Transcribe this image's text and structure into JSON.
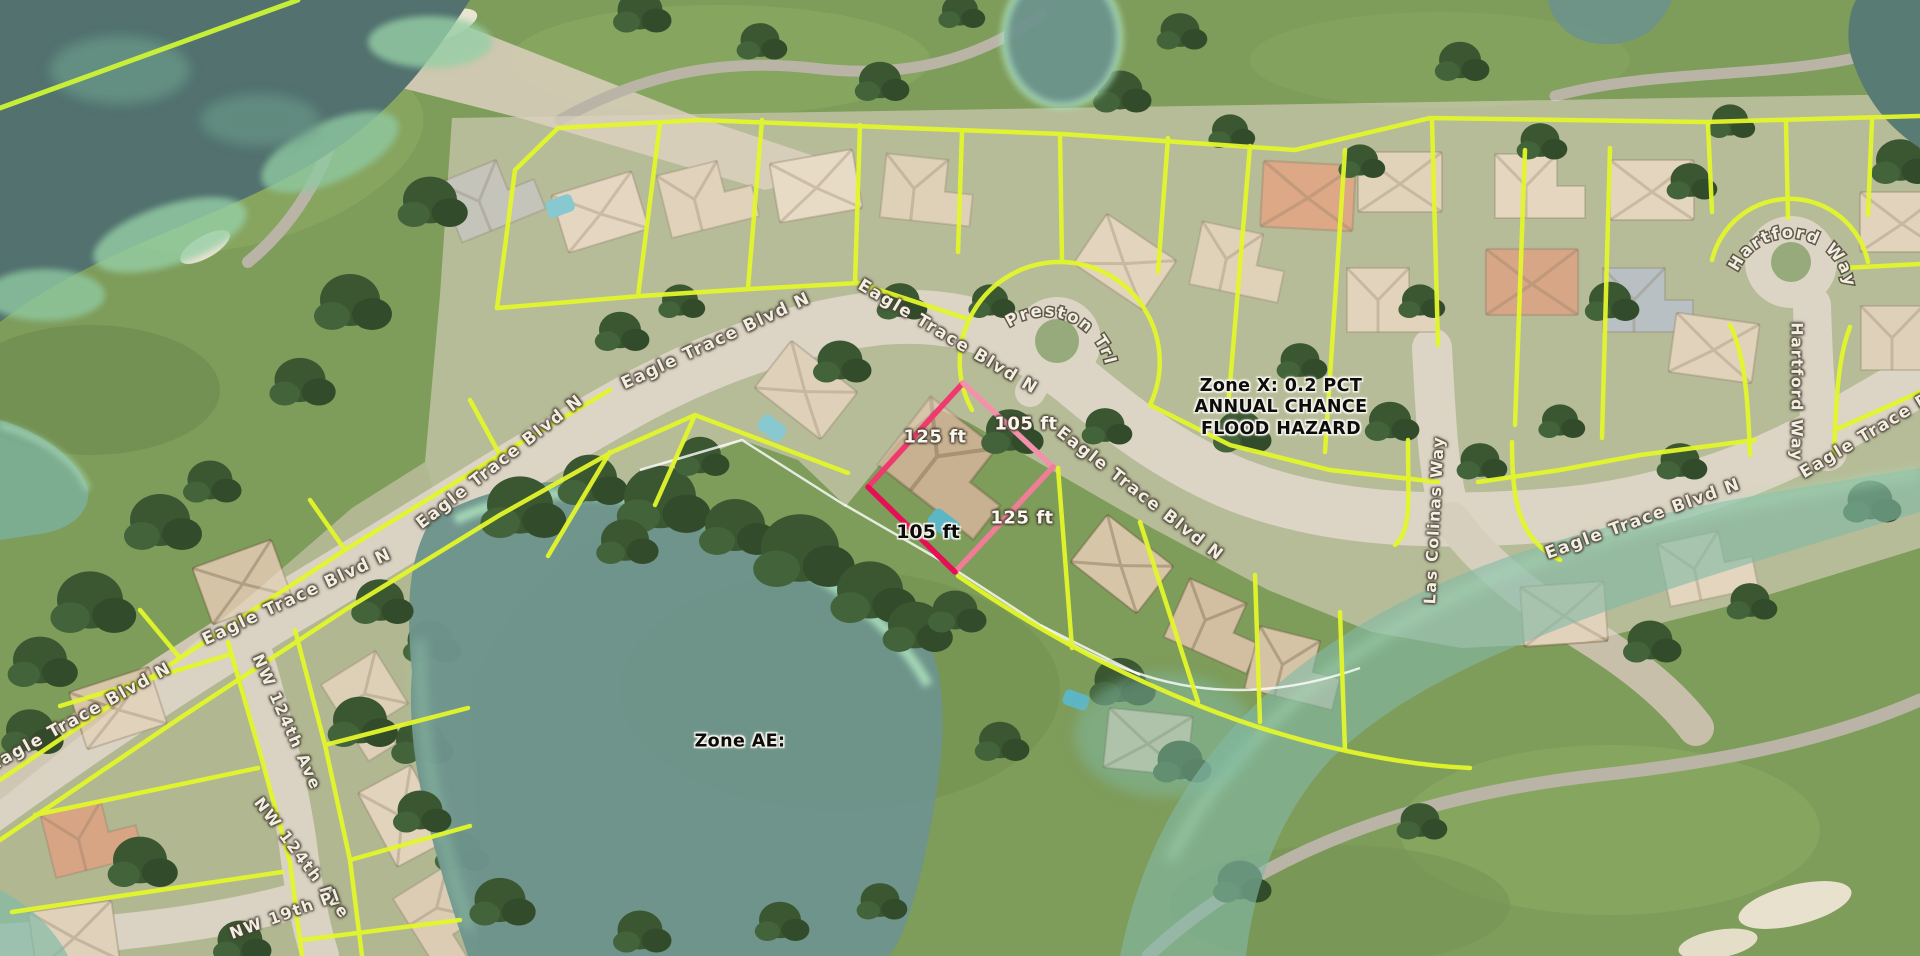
{
  "streets": {
    "eagle_trace_blvd_n": "Eagle Trace Blvd N",
    "eagle_trace_blvd": "Eagle Trace Blvd",
    "preston_trl": "Preston Trl",
    "las_colinas_way": "Las Colinas Way",
    "hartford_way": "Hartford Way",
    "nw_124th_ave": "NW 124th Ave",
    "nw_19th_pl": "NW 19th Pl"
  },
  "flood_zones": {
    "zone_x": [
      "Zone X: 0.2 PCT",
      "ANNUAL CHANCE",
      "FLOOD HAZARD"
    ],
    "zone_ae": "Zone AE:"
  },
  "selected_parcel": {
    "front_label": "125 ft",
    "side_label": "105 ft",
    "outline_color": "#ee2a62"
  },
  "legend_colors": {
    "parcel_boundary_yellow": "#e3f62b",
    "flood_zone_teal": "#6d948c",
    "flood_fringe_mint": "#a9dcb9",
    "selection_pink": "#ee2a62"
  }
}
